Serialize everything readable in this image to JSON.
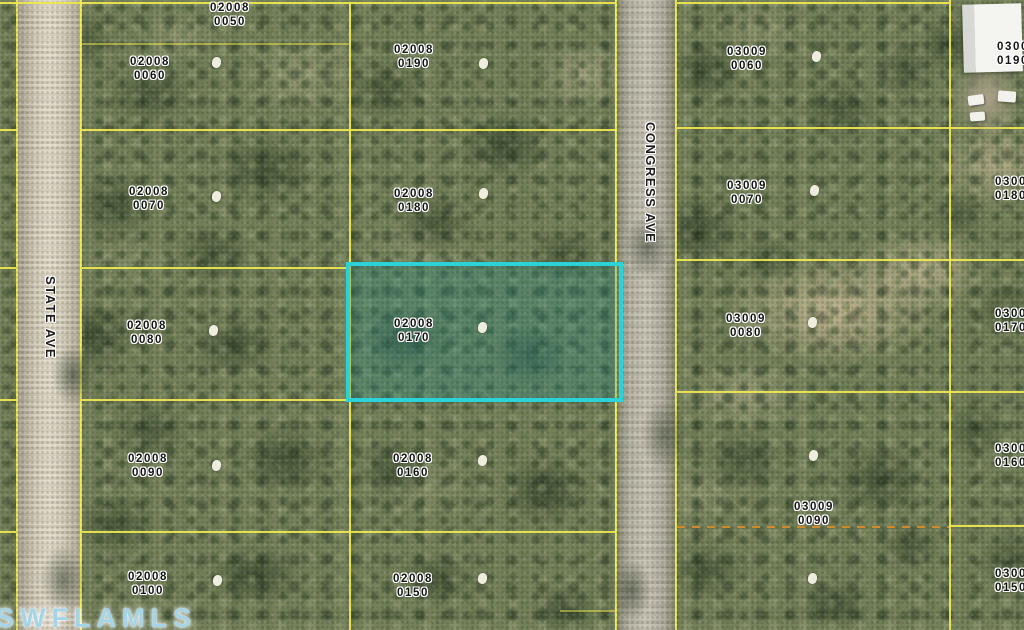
{
  "map": {
    "type": "aerial-parcel-map",
    "watermark": "SWFLAMLS",
    "roads": [
      {
        "name": "STATE AVE"
      },
      {
        "name": "CONGRESS AVE"
      }
    ],
    "highlight": {
      "parcel": "02008 0170",
      "border_color": "#2bd3d8"
    },
    "boundary_color": "#efe94f",
    "parcels": [
      {
        "line1": "02008",
        "line2": "0050",
        "cx": 230,
        "y": 2
      },
      {
        "line1": "02008",
        "line2": "0060",
        "cx": 150,
        "y": 56
      },
      {
        "line1": "02008",
        "line2": "0070",
        "cx": 149,
        "y": 186
      },
      {
        "line1": "02008",
        "line2": "0080",
        "cx": 147,
        "y": 320
      },
      {
        "line1": "02008",
        "line2": "0090",
        "cx": 148,
        "y": 453
      },
      {
        "line1": "02008",
        "line2": "0100",
        "cx": 148,
        "y": 571
      },
      {
        "line1": "02008",
        "line2": "0190",
        "cx": 414,
        "y": 44
      },
      {
        "line1": "02008",
        "line2": "0180",
        "cx": 414,
        "y": 188
      },
      {
        "line1": "02008",
        "line2": "0170",
        "cx": 414,
        "y": 318
      },
      {
        "line1": "02008",
        "line2": "0160",
        "cx": 413,
        "y": 453
      },
      {
        "line1": "02008",
        "line2": "0150",
        "cx": 413,
        "y": 573
      },
      {
        "line1": "03009",
        "line2": "0060",
        "cx": 747,
        "y": 46
      },
      {
        "line1": "03009",
        "line2": "0070",
        "cx": 747,
        "y": 180
      },
      {
        "line1": "03009",
        "line2": "0080",
        "cx": 746,
        "y": 313
      },
      {
        "line1": "03009",
        "line2": "0090",
        "cx": 814,
        "y": 501
      },
      {
        "line1": "0300",
        "line2": "0190",
        "x": 997,
        "y": 41
      },
      {
        "line1": "0300",
        "line2": "0180",
        "x": 995,
        "y": 176
      },
      {
        "line1": "0300",
        "line2": "0170",
        "x": 995,
        "y": 308
      },
      {
        "line1": "0300",
        "line2": "0160",
        "x": 995,
        "y": 443
      },
      {
        "line1": "0300",
        "line2": "0150",
        "x": 995,
        "y": 568
      }
    ],
    "markers": [
      [
        216,
        62
      ],
      [
        216,
        196
      ],
      [
        213,
        330
      ],
      [
        216,
        465
      ],
      [
        217,
        580
      ],
      [
        483,
        63
      ],
      [
        483,
        193
      ],
      [
        482,
        327
      ],
      [
        482,
        460
      ],
      [
        482,
        578
      ],
      [
        816,
        56
      ],
      [
        814,
        190
      ],
      [
        812,
        322
      ],
      [
        813,
        455
      ],
      [
        812,
        578
      ]
    ]
  }
}
